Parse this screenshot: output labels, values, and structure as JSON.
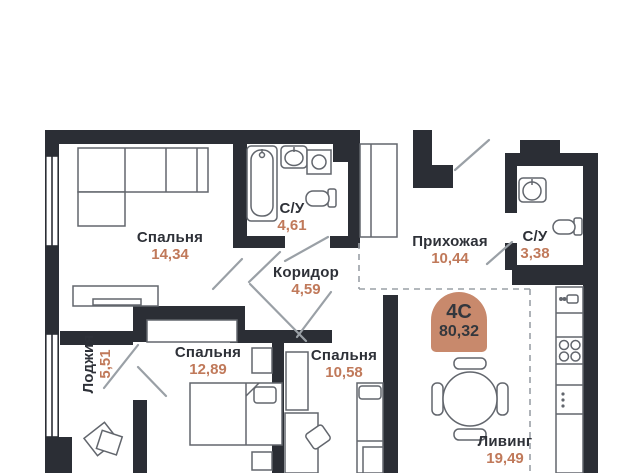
{
  "plan": {
    "title": "floor-plan",
    "badge": {
      "type": "4С",
      "total_area": "80,32"
    },
    "rooms": [
      {
        "id": "bedroom-1",
        "name": "Спальня",
        "area": "14,34"
      },
      {
        "id": "bathroom-1",
        "name": "С/У",
        "area": "4,61"
      },
      {
        "id": "hallway",
        "name": "Прихожая",
        "area": "10,44"
      },
      {
        "id": "bathroom-2",
        "name": "С/У",
        "area": "3,38"
      },
      {
        "id": "corridor",
        "name": "Коридор",
        "area": "4,59"
      },
      {
        "id": "loggia",
        "name": "Лоджия",
        "area": "5,51"
      },
      {
        "id": "bedroom-2",
        "name": "Спальня",
        "area": "12,89"
      },
      {
        "id": "bedroom-3",
        "name": "Спальня",
        "area": "10,58"
      },
      {
        "id": "living",
        "name": "Ливинг",
        "area": "19,49"
      }
    ],
    "colors": {
      "wall": "#2b2e35",
      "label_text": "#2e3138",
      "area_text": "#c0795a",
      "badge_bg": "#c8896c",
      "furniture_stroke": "#62666d",
      "door_stroke": "#9aa0a6"
    }
  }
}
